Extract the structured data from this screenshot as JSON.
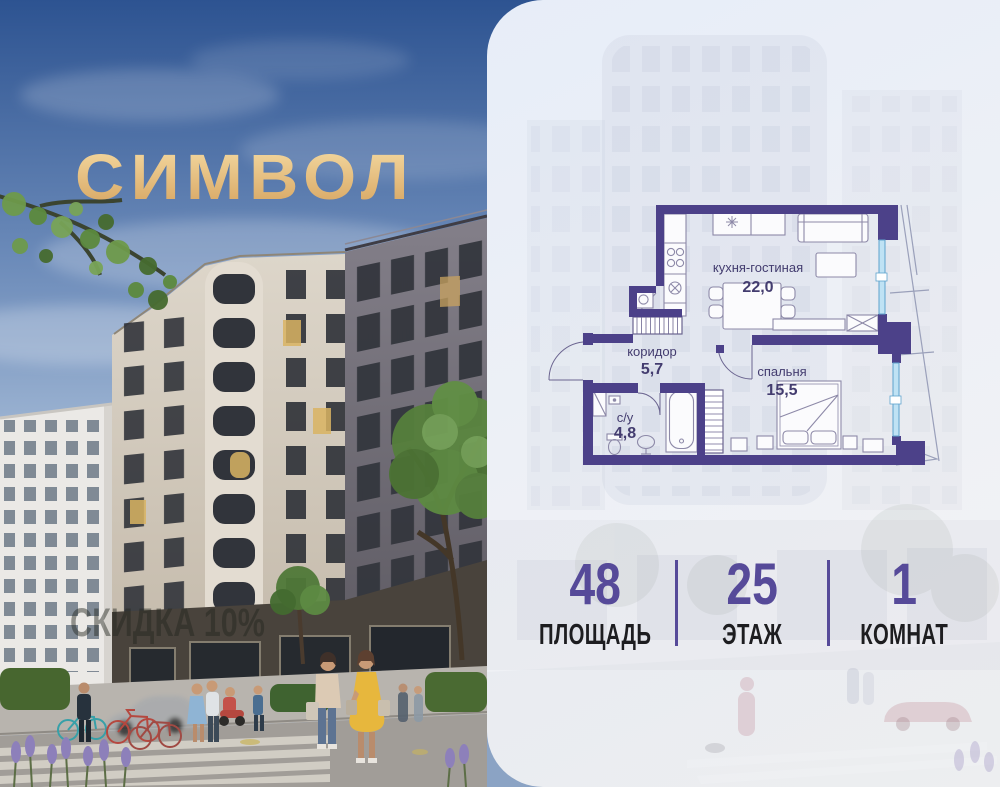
{
  "brand": {
    "logo": "СИМВОЛ",
    "gold_top": "#f6dda6",
    "gold_bottom": "#d5a25e"
  },
  "photo": {
    "watermark": "СКИДКА 10%"
  },
  "panel": {
    "background": "#edf1f7"
  },
  "floor_plan": {
    "wall_color": "#4c4189",
    "window_color": "#bfe2f4",
    "label_color": "#433c6f",
    "rooms": [
      {
        "name": "кухня-гостиная",
        "area": "22,0"
      },
      {
        "name": "коридор",
        "area": "5,7"
      },
      {
        "name": "спальня",
        "area": "15,5"
      },
      {
        "name": "с/у",
        "area": "4,8"
      }
    ]
  },
  "stats": {
    "value_color": "#564a99",
    "label_color": "#1d1d20",
    "divider_color": "#564a99",
    "items": [
      {
        "value": "48",
        "label": "ПЛОЩАДЬ"
      },
      {
        "value": "25",
        "label": "ЭТАЖ"
      },
      {
        "value": "1",
        "label": "КОМНАТ"
      }
    ]
  }
}
